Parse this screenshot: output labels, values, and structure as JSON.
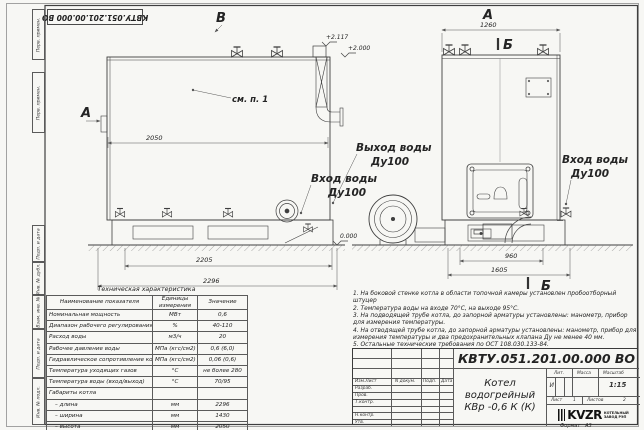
{
  "stamp_top": "КВТУ.051.201.00.000  ВО",
  "margin_boxes": [
    {
      "label": "Перв. примен."
    },
    {
      "label": "Перв. примен."
    },
    {
      "label": "Подп. и дата"
    },
    {
      "label": "Инв. № дубл."
    },
    {
      "label": "Взам. инв. №"
    },
    {
      "label": "Подп. и дата"
    },
    {
      "label": "Инв. № подл."
    }
  ],
  "drawing": {
    "view_b_label": "В",
    "view_a_top_label": "А",
    "view_a_side_label": "А",
    "section_b_top": "Б",
    "section_b_bottom": "Б",
    "see_note": "см. п. 1",
    "elev_top": "+2.117",
    "elev_roof": "+2.000",
    "elev_zero": "0.000",
    "dim_left_top": "2050",
    "dim_left_mid": "2205",
    "dim_left_bottom": "2296",
    "dim_right_top": "1260",
    "dim_right_mid": "960",
    "dim_right_bottom": "1605",
    "outlet_label": "Выход воды",
    "outlet_dn": "Ду100",
    "inlet_left_label": "Вход воды",
    "inlet_left_dn": "Ду100",
    "inlet_right_label": "Вход воды",
    "inlet_right_dn": "Ду100"
  },
  "tech_table": {
    "title": "Техническая характеристика",
    "col_name": "Наименование показателя",
    "col_units_1": "Единицы",
    "col_units_2": "измерения",
    "col_value": "Значение",
    "rows": [
      {
        "name": "Номинальная мощность",
        "units": "МВт",
        "value": "0,6"
      },
      {
        "name": "Диапазон рабочего регулирования",
        "units": "%",
        "value": "40-110"
      },
      {
        "name": "Расход воды",
        "units": "м3/ч",
        "value": "20"
      },
      {
        "name": "Рабочее давление воды",
        "units": "МПа (кгс/см2)",
        "value": "0,6 (6,0)"
      },
      {
        "name": "Гидравлическое сопротивление котла",
        "units": "МПа (кгс/см2)",
        "value": "0,06 (0,6)"
      },
      {
        "name": "Температура уходящих газов",
        "units": "°С",
        "value": "не более 280"
      },
      {
        "name": "Температура воды (вход/выход)",
        "units": "°С",
        "value": "70/95"
      },
      {
        "name": "Габариты котла",
        "units": "",
        "value": ""
      },
      {
        "name": "– длина",
        "units": "мм",
        "value": "2296"
      },
      {
        "name": "– ширина",
        "units": "мм",
        "value": "1430"
      },
      {
        "name": "– высота",
        "units": "мм",
        "value": "2050"
      }
    ]
  },
  "notes": [
    "1. На боковой стенке котла в области топочной камеры установлен пробоотборный штуцер",
    "2. Температура воды на входе 70°С, на выходе 95°С.",
    "3. На подводящей трубе котла, до запорной арматуры установлены: манометр, прибор для измерения температуры.",
    "4. На отводящей трубе котла, до запорной арматуры установлены: манометр, прибор для измерения температуры и два предохранительных клапана Ду не менее 40 мм.",
    "5. Остальные технические требования по ОСТ 108.030.133-84."
  ],
  "title_block": {
    "doc_number": "КВТУ.051.201.00.000  ВО",
    "product_line1": "Котел водогрейный",
    "product_line2": "КВр -0,6  К  (К)",
    "col_izm": "Изм.Лист",
    "col_doc": "N докум.",
    "col_sign": "Подп.",
    "col_date": "Дата",
    "row_razrab": "Разраб.",
    "row_prov": "Пров.",
    "row_tkontr": "Т.контр.",
    "row_nkontr": "Н.контр.",
    "row_utv": "Утв.",
    "lit_header": "Лит.",
    "mass_header": "Масса",
    "scale_header": "Масштаб",
    "lit_value": "И",
    "scale_value": "1:15",
    "sheet_label": "Лист",
    "sheet_value": "1",
    "sheets_label": "Листов",
    "sheets_value": "2",
    "logo_text": "KVZR",
    "logo_sub1": "КОТЕЛЬНЫЙ",
    "logo_sub2": "ЗАВОД РЭП",
    "format_label": "Формат",
    "format_value": "А3"
  }
}
